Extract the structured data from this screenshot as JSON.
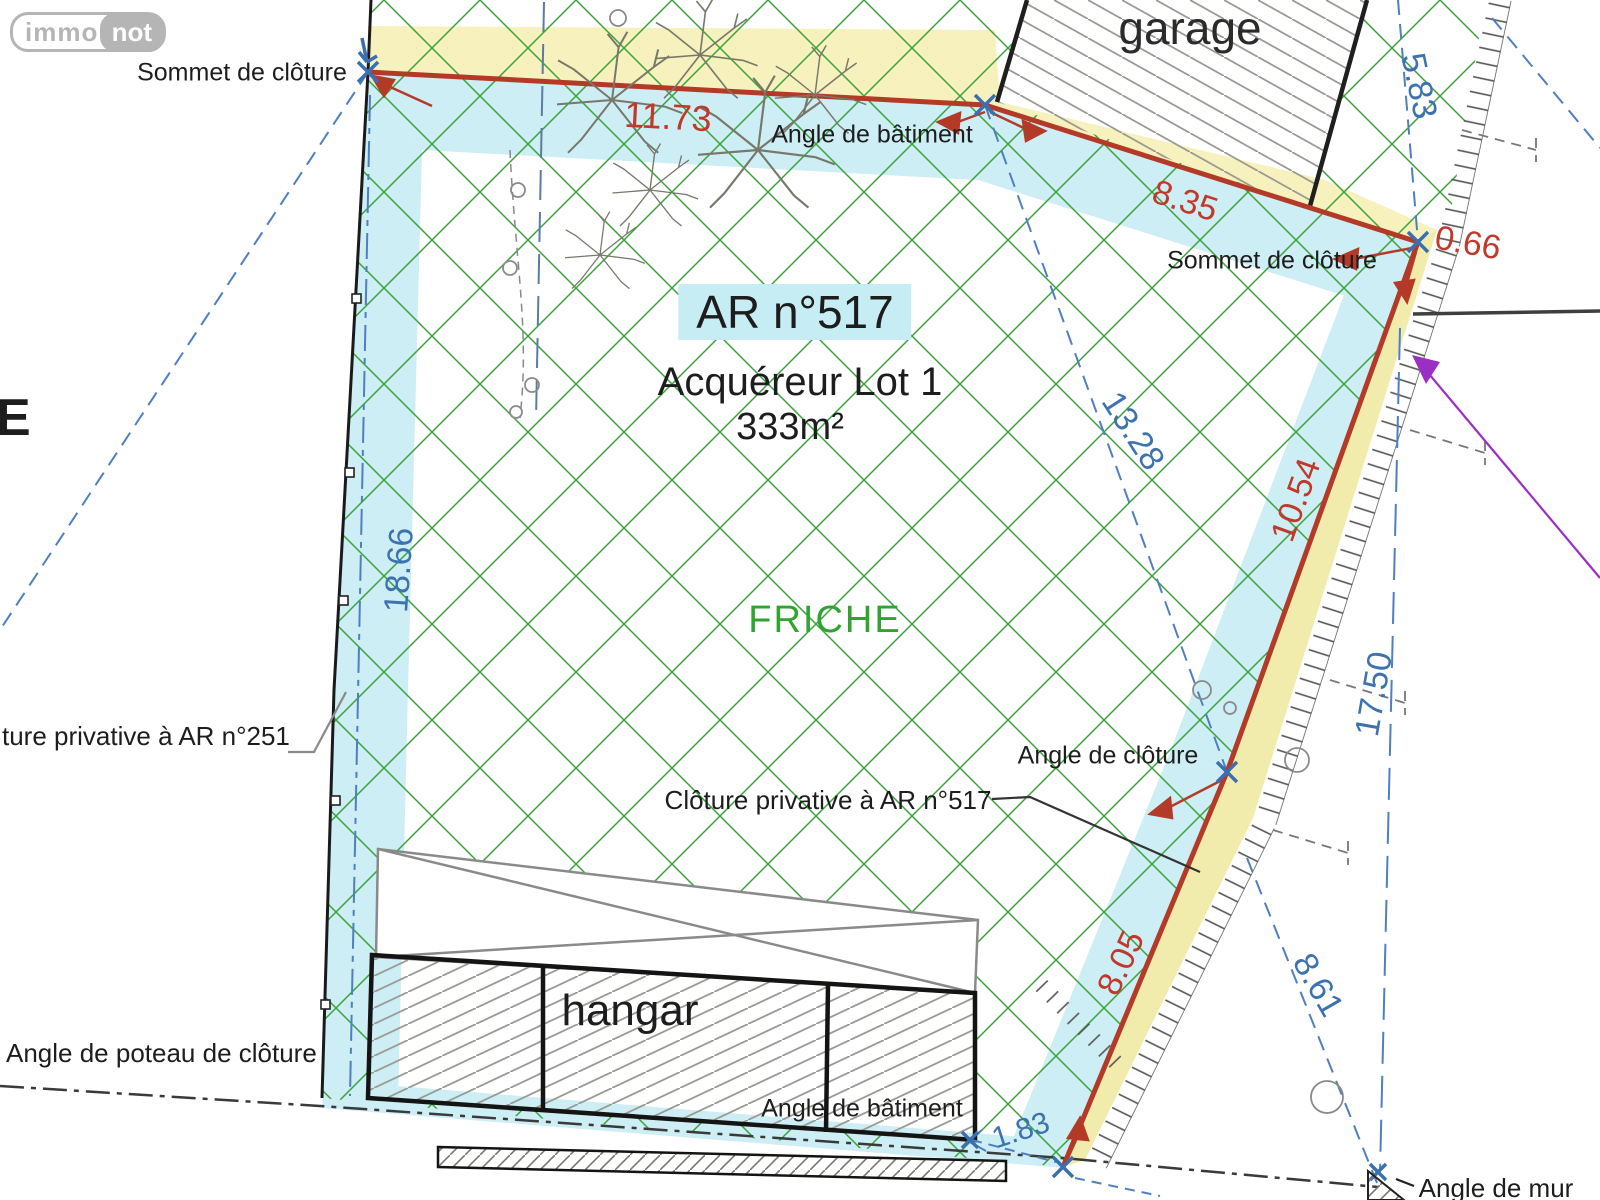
{
  "brand": {
    "logo_immo": "immo",
    "logo_not": "not"
  },
  "parcel": {
    "reference": "AR n°517",
    "buyer_line": "Acquéreur Lot 1",
    "area": "333m²",
    "land_state": "FRICHE"
  },
  "buildings": {
    "garage_label": "garage",
    "hangar_label": "hangar"
  },
  "annotations": {
    "sommet_cloture_top": "Sommet de clôture",
    "angle_batiment_top": "Angle de bâtiment",
    "sommet_cloture_right": "Sommet de clôture",
    "angle_cloture": "Angle de clôture",
    "cloture_privative_ar251": "ture privative à AR n°251",
    "cloture_privative_ar517": "Clôture privative à AR n°517",
    "angle_poteau_cloture": "Angle de poteau de clôture",
    "angle_batiment_bottom": "Angle de bâtiment",
    "angle_mur": "Angle de mur",
    "edge_letter": "E"
  },
  "measurements_red": [
    {
      "label": "11.73"
    },
    {
      "label": "8.35"
    },
    {
      "label": "0.66"
    },
    {
      "label": "10.54"
    },
    {
      "label": "8.05"
    }
  ],
  "measurements_blue": [
    {
      "label": "5.83"
    },
    {
      "label": "13.28"
    },
    {
      "label": "18.66"
    },
    {
      "label": "17.50"
    },
    {
      "label": "8.61"
    },
    {
      "label": "1.83"
    }
  ],
  "colors": {
    "boundary_red": "#b43a28",
    "measure_red": "#c0392b",
    "measure_blue": "#3c72b0",
    "band_cyan": "#cdeef4",
    "band_yellow": "#f6f1bd",
    "hatch_green": "#3aa23a",
    "friche_green": "#2ea52e",
    "purple": "#9a2fc4",
    "logo_grey": "#b5b5b5"
  }
}
